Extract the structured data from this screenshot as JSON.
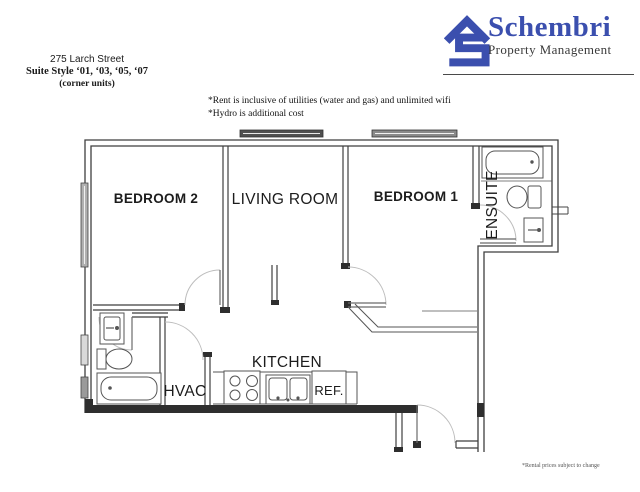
{
  "header": {
    "address": "275 Larch Street",
    "suite_style": "Suite Style ‘01, ‘03, ‘05, ‘07",
    "corner_units": "(corner units)"
  },
  "logo": {
    "name": "Schembri",
    "tagline": "Property Management",
    "brand_color": "#3b4fae"
  },
  "notes": {
    "line1": "*Rent is inclusive of utilities (water and gas) and unlimited wifi",
    "line2": "*Hydro is additional cost"
  },
  "floorplan": {
    "rooms": {
      "bedroom2": "BEDROOM 2",
      "living_room": "LIVING ROOM",
      "bedroom1": "BEDROOM 1",
      "ensuite": "ENSUITE",
      "kitchen": "KITCHEN",
      "hvac": "HVAC",
      "fridge": "REF."
    },
    "wall_color": "#3f3f3f"
  },
  "footer": {
    "disclaimer": "*Rental prices subject to change"
  }
}
